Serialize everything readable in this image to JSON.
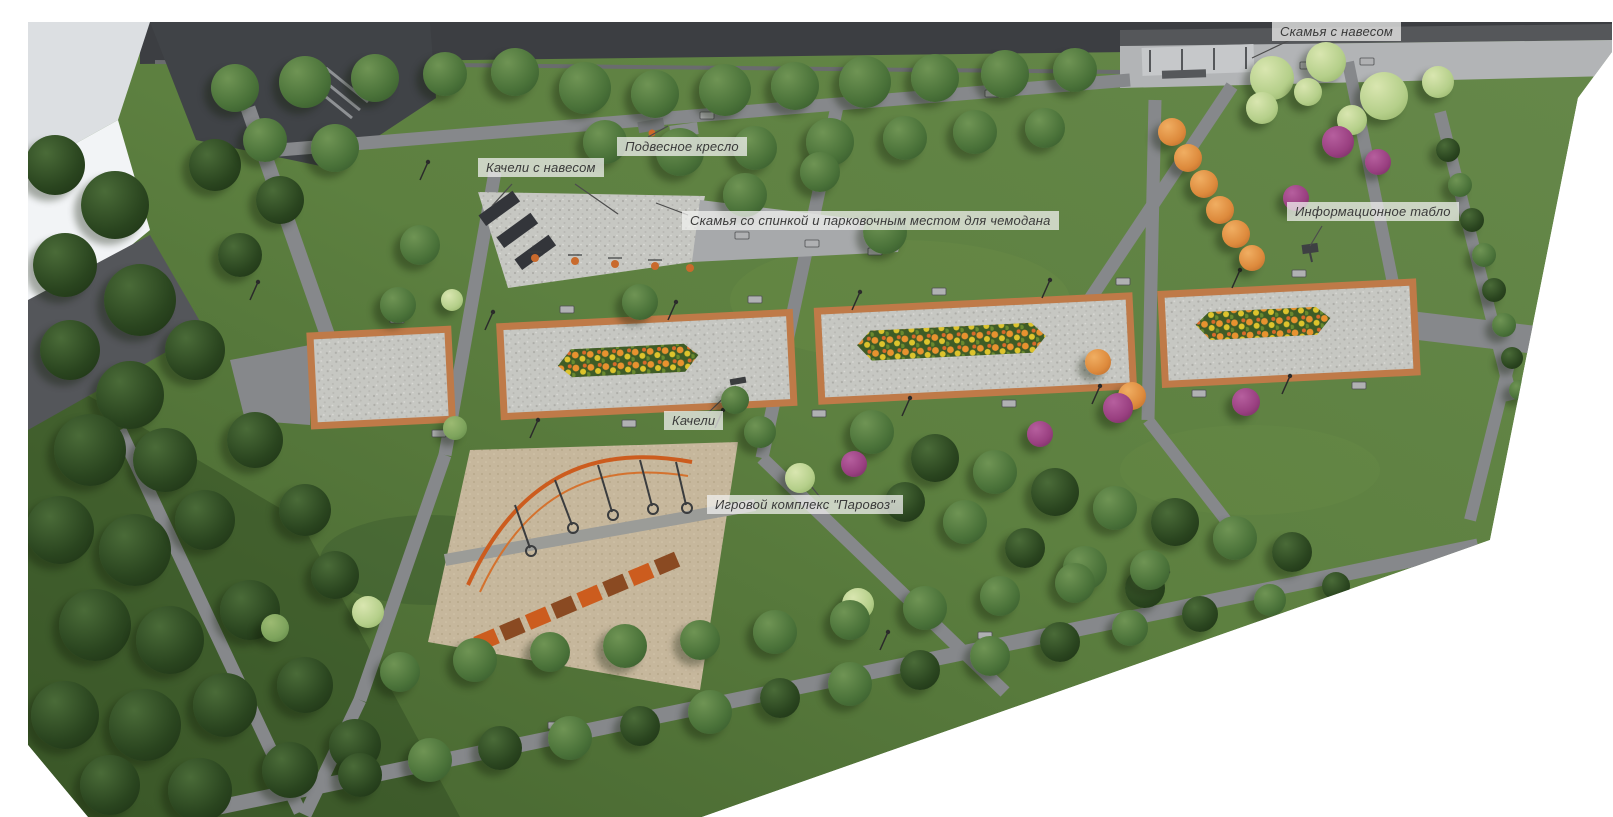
{
  "scene": {
    "description": "Aerial 3D visualization of a linear park landscaping concept with annotated amenities"
  },
  "annotations": [
    {
      "id": "bench-with-canopy",
      "text": "Скамья с навесом"
    },
    {
      "id": "hanging-chair",
      "text": "Подвесное кресло"
    },
    {
      "id": "swings-with-canopy",
      "text": "Качели с навесом"
    },
    {
      "id": "bench-with-backrest",
      "text": "Скамья со спинкой и парковочным местом для чемодана"
    },
    {
      "id": "info-board",
      "text": "Информационное табло"
    },
    {
      "id": "swings",
      "text": "Качели"
    },
    {
      "id": "play-complex",
      "text": "Игровой комплекс \"Паровоз\""
    }
  ],
  "colors": {
    "background": "#ffffff",
    "lawn": "#587a39",
    "lawn_dark": "#3f5e2c",
    "path_gray": "#86888b",
    "promenade_paving": "#c6c7c2",
    "brick_border": "#bf7a48",
    "plaza_paving": "#b9bbbd",
    "playground_sand": "#c6b79c",
    "play_equipment_orange": "#cc5c1e",
    "tree_green_dark": "#2a451f",
    "tree_green_medium": "#4a7239",
    "tree_green_light": "#7da35c",
    "tree_lime": "#b5cf8a",
    "tree_autumn_orange": "#dd8a3c",
    "shrub_purple": "#993f80",
    "flower_orange": "#e8922f",
    "flower_yellow": "#ddc32c",
    "road_dark": "#3c3e42",
    "label_text": "#3a3a3a"
  }
}
